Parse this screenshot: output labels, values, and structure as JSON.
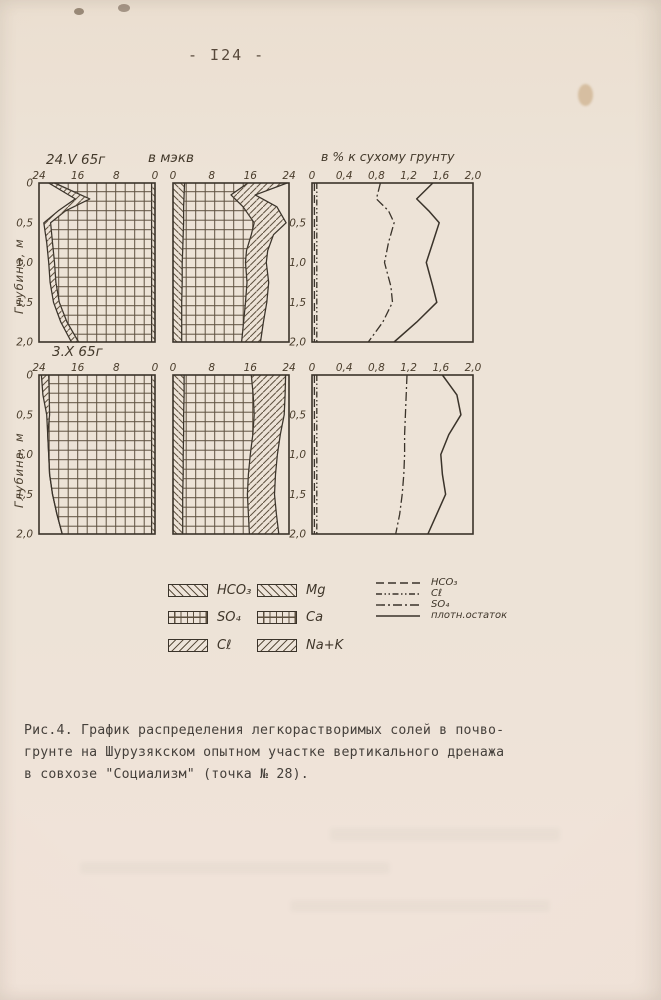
{
  "page": {
    "page_number": "- I24 -",
    "caption_line1": "Рис.4. График распределения легкорастворимых солей в почво-",
    "caption_line2": "грунте на Шурузякском опытном участке вертикального дренажа",
    "caption_line3": "в совхозе \"Социализм\" (точка № 28)."
  },
  "figure": {
    "row1_date": "24.V 65г",
    "row2_date": "3.X 65г",
    "meqv_title": "в мэкв",
    "percent_title": "в % к сухому грунту",
    "depth_axis_label": "Глубина, м",
    "depth_ticks": [
      {
        "label": "0",
        "v": 0
      },
      {
        "label": "0,5",
        "v": 0.5
      },
      {
        "label": "1,0",
        "v": 1.0
      },
      {
        "label": "1,5",
        "v": 1.5
      },
      {
        "label": "2,0",
        "v": 2.0
      }
    ]
  },
  "legend": {
    "patterns": [
      {
        "label": "HCO₃",
        "pattern": "backslash"
      },
      {
        "label": "Mg",
        "pattern": "backslash"
      },
      {
        "label": "SO₄",
        "pattern": "grid"
      },
      {
        "label": "Ca",
        "pattern": "grid"
      },
      {
        "label": "Cℓ",
        "pattern": "slash"
      },
      {
        "label": "Na+K",
        "pattern": "slash"
      }
    ],
    "lines": [
      {
        "label": "HCO₃",
        "dash": "dashed"
      },
      {
        "label": "Cℓ",
        "dash": "dashdotdot"
      },
      {
        "label": "SO₄",
        "dash": "dashdot"
      },
      {
        "label": "плотн.остаток",
        "dash": "solid"
      }
    ]
  },
  "chart_data": [
    {
      "name": "anions-meqv-24.V.65",
      "type": "area",
      "row": 1,
      "group": "anions",
      "mirrored": true,
      "xmax": 24,
      "depth_max": 2,
      "ylabel": "Глубина, м",
      "xlabel": "в мэкв",
      "x_ticks": [
        {
          "label": "24",
          "v": 24
        },
        {
          "label": "16",
          "v": 16
        },
        {
          "label": "8",
          "v": 8
        },
        {
          "label": "0",
          "v": 0
        }
      ],
      "depths": [
        0,
        0.2,
        0.35,
        0.5,
        0.75,
        1,
        1.25,
        1.5,
        1.75,
        2
      ],
      "series": [
        {
          "name": "HCO3",
          "pattern": "backslash",
          "boundary": [
            0.7,
            0.7,
            0.7,
            0.7,
            0.7,
            0.7,
            0.7,
            0.7,
            0.7,
            0.7
          ]
        },
        {
          "name": "SO4",
          "pattern": "grid",
          "boundary": [
            20.8,
            13.5,
            18.5,
            21.6,
            21.2,
            20.8,
            20.5,
            19.8,
            18.2,
            15.8
          ]
        },
        {
          "name": "Cl",
          "pattern": "slash",
          "boundary": [
            22,
            16.5,
            20,
            23,
            22.4,
            22,
            21.7,
            21,
            19.5,
            17.3
          ]
        }
      ]
    },
    {
      "name": "cations-meqv-24.V.65",
      "type": "area",
      "row": 1,
      "group": "cations",
      "mirrored": false,
      "xmax": 24,
      "depth_max": 2,
      "xlabel": "в мэкв",
      "x_ticks": [
        {
          "label": "0",
          "v": 0
        },
        {
          "label": "8",
          "v": 8
        },
        {
          "label": "16",
          "v": 16
        },
        {
          "label": "24",
          "v": 24
        }
      ],
      "depths": [
        0,
        0.15,
        0.3,
        0.5,
        0.65,
        0.85,
        1,
        1.25,
        1.5,
        1.75,
        2
      ],
      "series": [
        {
          "name": "Mg",
          "pattern": "backslash",
          "boundary": [
            2.4,
            2.3,
            2.2,
            2.2,
            2.1,
            2,
            1.9,
            1.9,
            1.8,
            1.8,
            1.8
          ]
        },
        {
          "name": "Ca",
          "pattern": "grid",
          "boundary": [
            15.5,
            12,
            14.5,
            16.8,
            16.2,
            15.2,
            15,
            15.3,
            15,
            14.6,
            14.2
          ]
        },
        {
          "name": "Na+K",
          "pattern": "slash",
          "boundary": [
            23.6,
            17,
            21.5,
            23.4,
            20.8,
            19.6,
            19.3,
            19.8,
            19.4,
            18.7,
            18.1
          ]
        }
      ]
    },
    {
      "name": "percent-dry-soil-24.V.65",
      "type": "line",
      "row": 1,
      "group": "percent",
      "mirrored": false,
      "xmax": 2,
      "depth_max": 2,
      "xlabel": "в % к сухому грунту",
      "x_ticks": [
        {
          "label": "0",
          "v": 0
        },
        {
          "label": "0,4",
          "v": 0.4
        },
        {
          "label": "0,8",
          "v": 0.8
        },
        {
          "label": "1,2",
          "v": 1.2
        },
        {
          "label": "1,6",
          "v": 1.6
        },
        {
          "label": "2,0",
          "v": 2
        }
      ],
      "depths": [
        0,
        0.2,
        0.35,
        0.5,
        0.75,
        1,
        1.3,
        1.5,
        1.75,
        2
      ],
      "series": [
        {
          "name": "HCO3",
          "dash": "dashed",
          "values": [
            0.03,
            0.03,
            0.03,
            0.03,
            0.03,
            0.03,
            0.03,
            0.03,
            0.03,
            0.03
          ]
        },
        {
          "name": "Cl",
          "dash": "dashdotdot",
          "values": [
            0.06,
            0.06,
            0.06,
            0.06,
            0.06,
            0.06,
            0.06,
            0.06,
            0.06,
            0.06
          ]
        },
        {
          "name": "SO4",
          "dash": "dashdot",
          "values": [
            0.85,
            0.8,
            0.95,
            1.02,
            0.95,
            0.9,
            0.98,
            1,
            0.88,
            0.7
          ]
        },
        {
          "name": "плотн.остаток",
          "dash": "solid",
          "values": [
            1.5,
            1.3,
            1.45,
            1.58,
            1.5,
            1.42,
            1.5,
            1.55,
            1.3,
            1.02
          ]
        }
      ]
    },
    {
      "name": "anions-meqv-3.X.65",
      "type": "area",
      "row": 2,
      "group": "anions",
      "mirrored": true,
      "xmax": 24,
      "depth_max": 2,
      "ylabel": "Глубина, м",
      "x_ticks": [
        {
          "label": "24",
          "v": 24
        },
        {
          "label": "16",
          "v": 16
        },
        {
          "label": "8",
          "v": 8
        },
        {
          "label": "0",
          "v": 0
        }
      ],
      "depths": [
        0,
        0.25,
        0.5,
        0.75,
        1,
        1.25,
        1.5,
        1.75,
        2
      ],
      "series": [
        {
          "name": "HCO3",
          "pattern": "backslash",
          "boundary": [
            0.7,
            0.7,
            0.7,
            0.7,
            0.7,
            0.7,
            0.7,
            0.7,
            0.7
          ]
        },
        {
          "name": "SO4",
          "pattern": "grid",
          "boundary": [
            22,
            21.9,
            21.8,
            22.2,
            22,
            21.8,
            21.2,
            20.3,
            19.2
          ]
        },
        {
          "name": "Cl",
          "pattern": "slash",
          "boundary": [
            23.5,
            23.2,
            22.4,
            22.2,
            22,
            21.8,
            21.2,
            20.3,
            19.2
          ]
        }
      ]
    },
    {
      "name": "cations-meqv-3.X.65",
      "type": "area",
      "row": 2,
      "group": "cations",
      "mirrored": false,
      "xmax": 24,
      "depth_max": 2,
      "x_ticks": [
        {
          "label": "0",
          "v": 0
        },
        {
          "label": "8",
          "v": 8
        },
        {
          "label": "16",
          "v": 16
        },
        {
          "label": "24",
          "v": 24
        }
      ],
      "depths": [
        0,
        0.25,
        0.5,
        0.75,
        1,
        1.25,
        1.5,
        1.75,
        2
      ],
      "series": [
        {
          "name": "Mg",
          "pattern": "backslash",
          "boundary": [
            2.3,
            2.3,
            2.2,
            2.2,
            2.1,
            2.1,
            2,
            2,
            2
          ]
        },
        {
          "name": "Ca",
          "pattern": "grid",
          "boundary": [
            16.2,
            16.6,
            16.8,
            16.5,
            16,
            15.6,
            15.4,
            15.6,
            15.8
          ]
        },
        {
          "name": "Na+K",
          "pattern": "slash",
          "boundary": [
            23.3,
            23.2,
            23,
            22.2,
            21.6,
            21.2,
            21,
            21.4,
            21.9
          ]
        }
      ]
    },
    {
      "name": "percent-dry-soil-3.X.65",
      "type": "line",
      "row": 2,
      "group": "percent",
      "mirrored": false,
      "xmax": 2,
      "depth_max": 2,
      "x_ticks": [
        {
          "label": "0",
          "v": 0
        },
        {
          "label": "0,4",
          "v": 0.4
        },
        {
          "label": "0,8",
          "v": 0.8
        },
        {
          "label": "1,2",
          "v": 1.2
        },
        {
          "label": "1,6",
          "v": 1.6
        },
        {
          "label": "2,0",
          "v": 2
        }
      ],
      "depths": [
        0,
        0.25,
        0.5,
        0.75,
        1,
        1.25,
        1.5,
        1.75,
        2
      ],
      "series": [
        {
          "name": "HCO3",
          "dash": "dashed",
          "values": [
            0.03,
            0.03,
            0.03,
            0.03,
            0.03,
            0.03,
            0.03,
            0.03,
            0.03
          ]
        },
        {
          "name": "Cl",
          "dash": "dashdotdot",
          "values": [
            0.06,
            0.06,
            0.06,
            0.06,
            0.06,
            0.06,
            0.06,
            0.06,
            0.06
          ]
        },
        {
          "name": "SO4",
          "dash": "dashdot",
          "values": [
            1.18,
            1.17,
            1.16,
            1.15,
            1.15,
            1.14,
            1.12,
            1.09,
            1.04
          ]
        },
        {
          "name": "плотн.остаток",
          "dash": "solid",
          "values": [
            1.62,
            1.8,
            1.85,
            1.7,
            1.6,
            1.62,
            1.66,
            1.55,
            1.44
          ]
        }
      ]
    }
  ]
}
